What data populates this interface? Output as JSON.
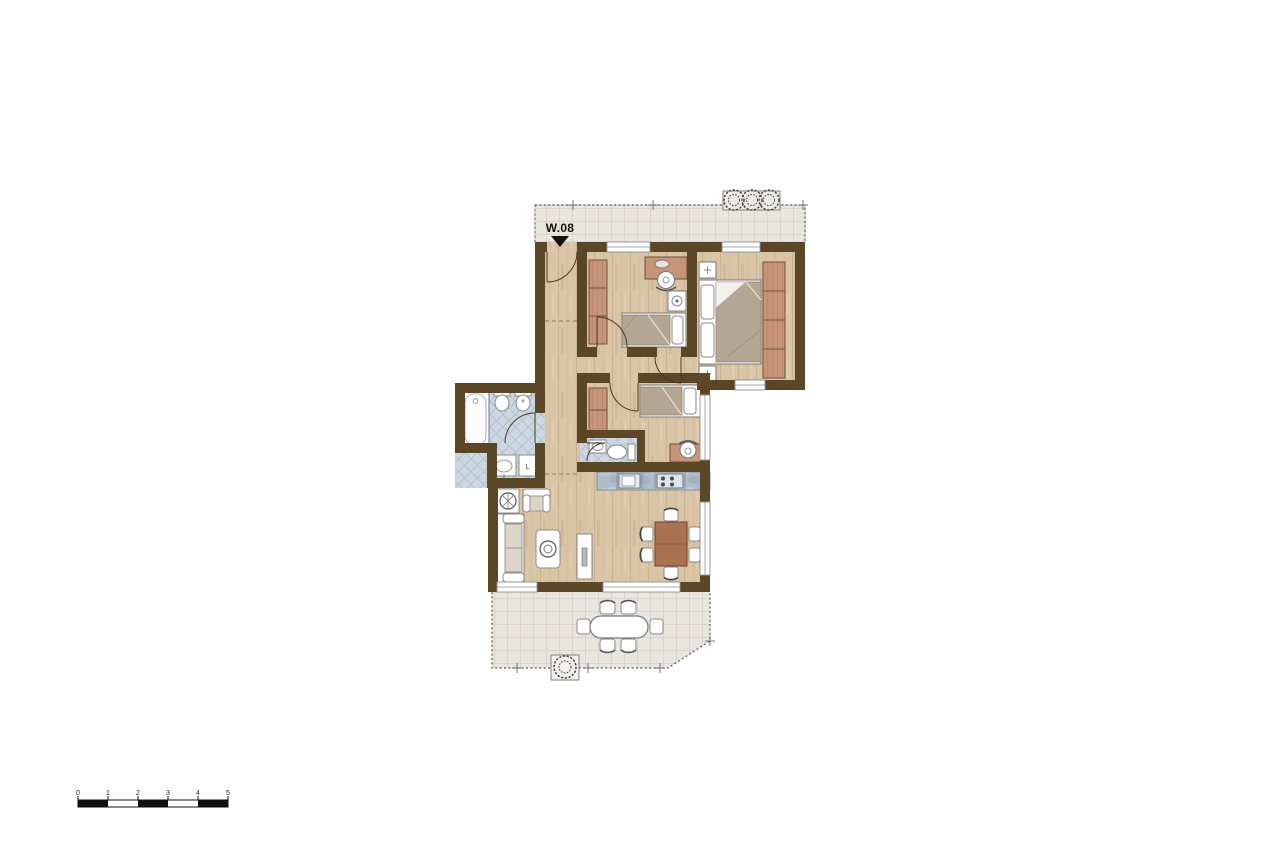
{
  "canvas": {
    "width": 1280,
    "height": 854,
    "background": "#ffffff"
  },
  "plan": {
    "unit_label": "W.08",
    "labels": {
      "washing_machine": "L"
    },
    "colors": {
      "wall": "#5b4726",
      "wood_floor": "#d9c4a6",
      "wardrobe": "#c7947a",
      "bed_blanket": "#b3a693",
      "bathroom_tile": "#ccd7e1",
      "terrace_tile": "#e9e6e0",
      "kitchen_counter": "#aebdc9",
      "dining_table": "#aa7250",
      "window": "#ffffff",
      "entry_marker": "#111111"
    },
    "symbols": [
      "entry-arrow-icon",
      "door-swing-icon",
      "window-icon",
      "bathtub-icon",
      "toilet-icon",
      "bidet-icon",
      "sink-icon",
      "washing-machine-icon",
      "bed-double-icon",
      "bed-single-icon",
      "wardrobe-icon",
      "desk-icon",
      "desk-chair-icon",
      "nightstand-icon",
      "sofa-icon",
      "armchair-icon",
      "coffee-table-icon",
      "tv-board-icon",
      "side-table-icon",
      "dining-table-icon",
      "dining-chair-icon",
      "kitchen-sink-icon",
      "stove-icon",
      "plant-icon",
      "outdoor-table-icon",
      "survey-cross-icon"
    ]
  },
  "scale_bar": {
    "ticks": [
      "0",
      "1",
      "2",
      "3",
      "4",
      "5"
    ]
  }
}
